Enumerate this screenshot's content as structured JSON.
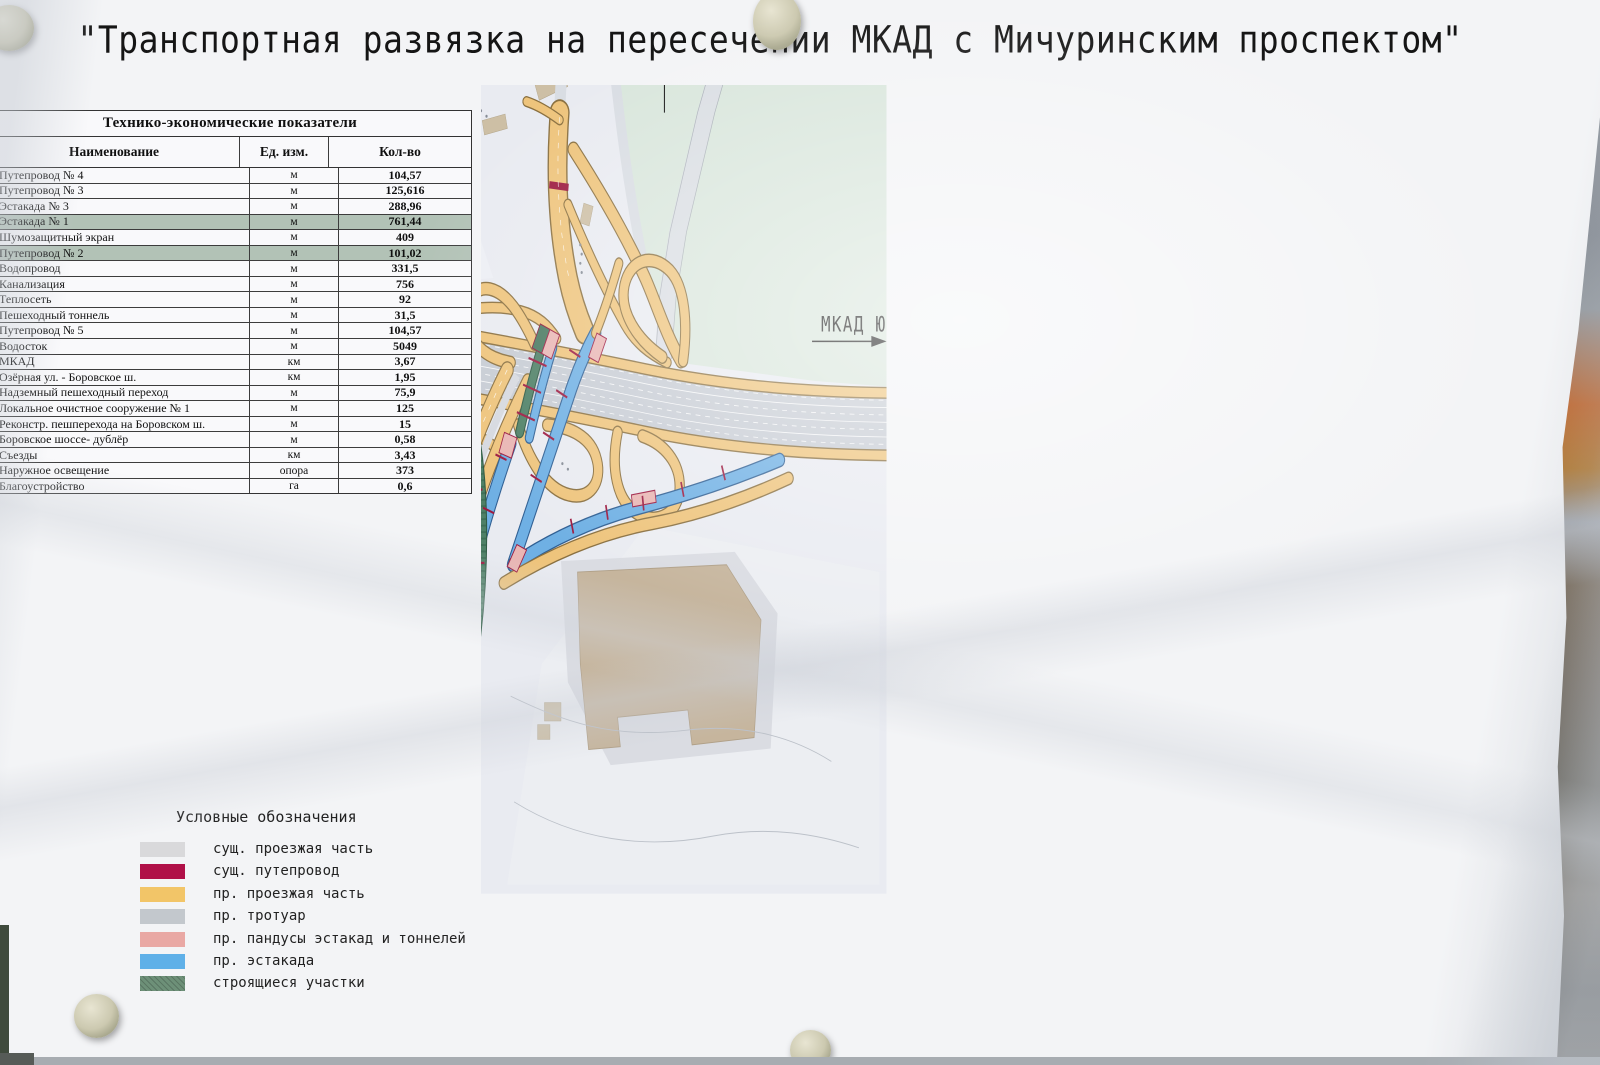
{
  "title": "\"Транспортная развязка на пересечении МКАД с Мичуринским проспектом\"",
  "table": {
    "title": "Технико-экономические показатели",
    "columns": [
      "Наименование",
      "Ед. изм.",
      "Кол-во"
    ],
    "rows": [
      {
        "name": "Путепровод № 4",
        "unit": "м",
        "qty": "104,57",
        "highlight": false
      },
      {
        "name": "Путепровод № 3",
        "unit": "м",
        "qty": "125,616",
        "highlight": false
      },
      {
        "name": "Эстакада № 3",
        "unit": "м",
        "qty": "288,96",
        "highlight": false
      },
      {
        "name": "Эстакада № 1",
        "unit": "м",
        "qty": "761,44",
        "highlight": true
      },
      {
        "name": "Шумозащитный экран",
        "unit": "м",
        "qty": "409",
        "highlight": false
      },
      {
        "name": "Путепровод № 2",
        "unit": "м",
        "qty": "101,02",
        "highlight": true
      },
      {
        "name": "Водопровод",
        "unit": "м",
        "qty": "331,5",
        "highlight": false
      },
      {
        "name": "Канализация",
        "unit": "м",
        "qty": "756",
        "highlight": false
      },
      {
        "name": "Теплосеть",
        "unit": "м",
        "qty": "92",
        "highlight": false
      },
      {
        "name": "Пешеходный тоннель",
        "unit": "м",
        "qty": "31,5",
        "highlight": false
      },
      {
        "name": "Путепровод № 5",
        "unit": "м",
        "qty": "104,57",
        "highlight": false
      },
      {
        "name": "Водосток",
        "unit": "м",
        "qty": "5049",
        "highlight": false
      },
      {
        "name": "МКАД",
        "unit": "км",
        "qty": "3,67",
        "highlight": false
      },
      {
        "name": "Озёрная ул. - Боровское ш.",
        "unit": "км",
        "qty": "1,95",
        "highlight": false
      },
      {
        "name": "Надземный пешеходный переход",
        "unit": "м",
        "qty": "75,9",
        "highlight": false
      },
      {
        "name": "Локальное очистное сооружение № 1",
        "unit": "м",
        "qty": "125",
        "highlight": false
      },
      {
        "name": "Реконстр. пешперехода на Боровском ш.",
        "unit": "м",
        "qty": "15",
        "highlight": false
      },
      {
        "name": "Боровское шоссе- дублёр",
        "unit": "м",
        "qty": "0,58",
        "highlight": false
      },
      {
        "name": "Съезды",
        "unit": "км",
        "qty": "3,43",
        "highlight": false
      },
      {
        "name": "Наружное освещение",
        "unit": "опора",
        "qty": "373",
        "highlight": false
      },
      {
        "name": "Благоустройство",
        "unit": "га",
        "qty": "0,6",
        "highlight": false
      }
    ]
  },
  "legend": {
    "title": "Условные обозначения",
    "items": [
      {
        "label": "сущ. проезжая часть",
        "color": "#d9d9db",
        "hatch": false
      },
      {
        "label": "сущ. путепровод",
        "color": "#b01048",
        "hatch": false
      },
      {
        "label": "пр. проезжая часть",
        "color": "#f2c568",
        "hatch": false
      },
      {
        "label": "пр. тротуар",
        "color": "#c3c8cd",
        "hatch": false
      },
      {
        "label": "пр. пандусы эстакад и тоннелей",
        "color": "#e9a8a4",
        "hatch": false
      },
      {
        "label": "пр. эстакада",
        "color": "#5fb0e8",
        "hatch": false
      },
      {
        "label": "строящиеся участки",
        "color": "#6d9078",
        "hatch": true
      }
    ]
  },
  "map_labels": {
    "moscow": "МОСКВА",
    "mkad_west": "МКАД ЗАПАД",
    "mkad_south": "МКАД ЮГ",
    "oblast": "ОБЛАСТЬ"
  },
  "colors": {
    "mkad_gray": "#c7ccd4",
    "road_yellow": "#eec47c",
    "elevated_blue": "#6fb0e4",
    "construction_green": "#4e8066",
    "ramp_pink": "#e9b6b4",
    "existing_crimson": "#9c1a40",
    "mint_area": "#d9e6dc",
    "building_tan": "#cdbfa5",
    "table_highlight": "#b2c2b6"
  }
}
